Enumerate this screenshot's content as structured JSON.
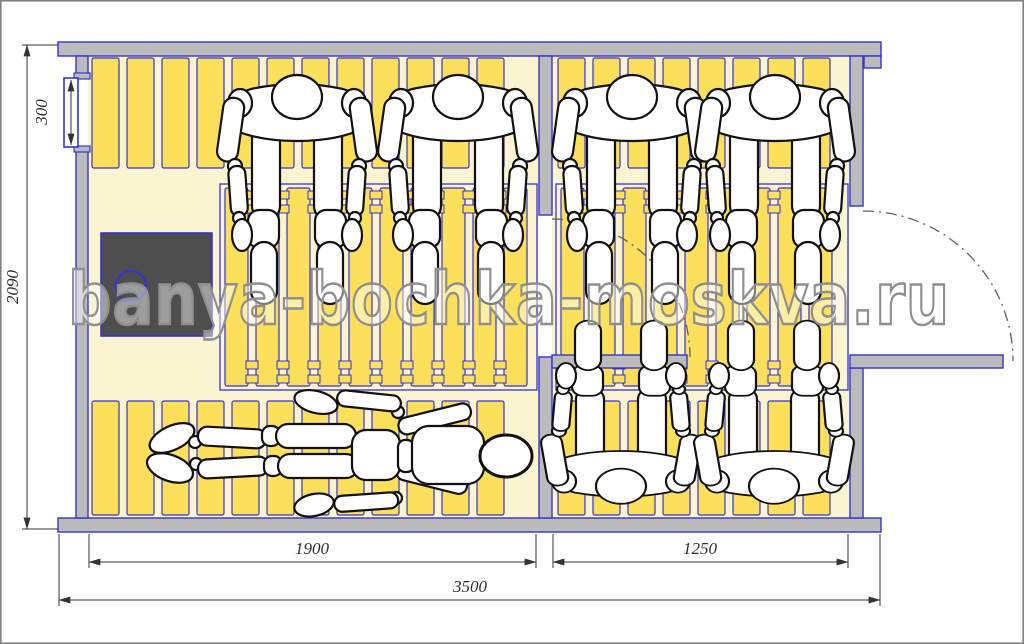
{
  "watermark": {
    "text": "banya-bochka-moskva.ru"
  },
  "dimensions": {
    "window_height_mm": "300",
    "plan_depth_mm": "2090",
    "steam_room_width_mm": "1900",
    "entrance_room_width_mm": "1250",
    "overall_width_mm": "3500"
  },
  "colors": {
    "outline_blue": "#3434CF",
    "wall_gray": "#BBBBBB",
    "floor_cream": "#FBF4D1",
    "slat_yellow": "#FCE05C",
    "stove_dark": "#4E4E4E",
    "dimension_ink": "#333333",
    "watermark_gray": "#8F8F8F",
    "figure_white": "#FFFFFF",
    "figure_outline": "#111111"
  }
}
